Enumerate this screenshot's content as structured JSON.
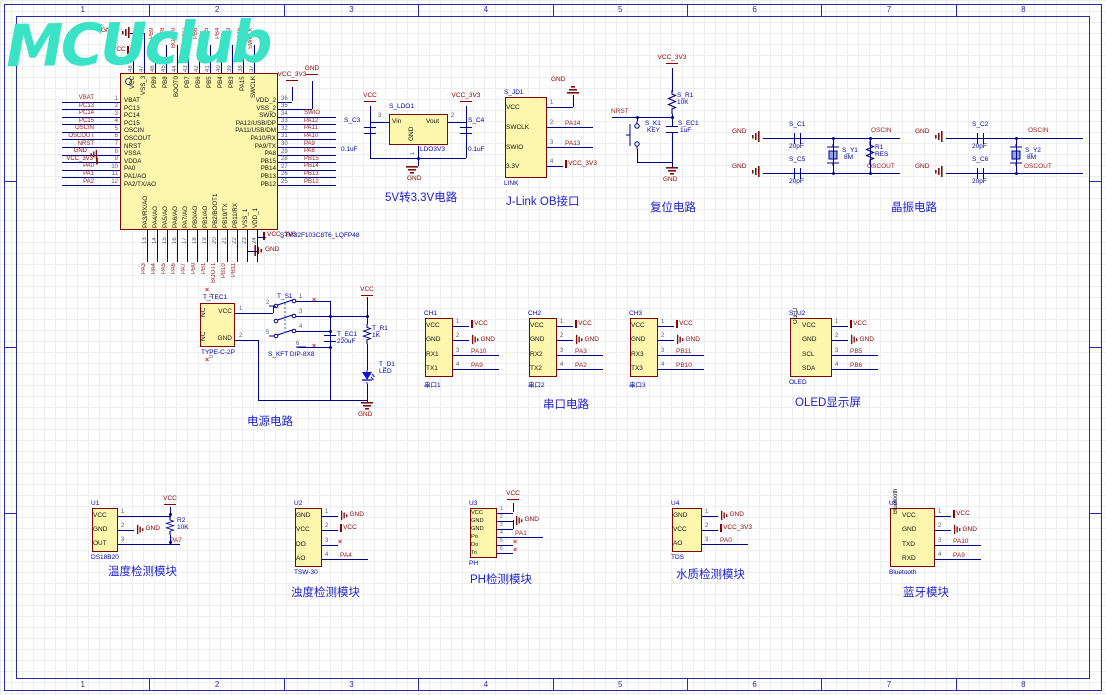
{
  "sheet": {
    "zones": [
      "1",
      "2",
      "3",
      "4",
      "5",
      "6",
      "7",
      "8"
    ]
  },
  "logo": {
    "text": "MCUclub"
  },
  "colors": {
    "wire": "#00008B",
    "net_label": "#9B1C1C",
    "power": "#8B0000",
    "component_fill": "#FCF7AD",
    "component_border": "#7C0606",
    "annotation": "#0202A8",
    "title": "#2121C8",
    "pin_number": "#5C5C74",
    "border": "#2A2AA8",
    "logo": "#3BE3C6"
  },
  "mcu": {
    "part": "STM32F103C8T6_LQFP48",
    "left_pins": [
      {
        "num": "1",
        "name": "VBAT",
        "net": "VBAT",
        "k": "net"
      },
      {
        "num": "2",
        "name": "PC13",
        "net": "PC13",
        "k": "net"
      },
      {
        "num": "3",
        "name": "PC14",
        "net": "PC14",
        "k": "net"
      },
      {
        "num": "4",
        "name": "PC15",
        "net": "PC15",
        "k": "net"
      },
      {
        "num": "5",
        "name": "OSCIN",
        "net": "OSCIN",
        "k": "net"
      },
      {
        "num": "6",
        "name": "OSCOUT",
        "net": "OSCOUT",
        "k": "net"
      },
      {
        "num": "7",
        "name": "NRST",
        "net": "NRST",
        "k": "net"
      },
      {
        "num": "8",
        "name": "VSSA",
        "net": "GND",
        "k": "gnd"
      },
      {
        "num": "9",
        "name": "VDDA",
        "net": "VCC_3V3",
        "k": "vcc"
      },
      {
        "num": "10",
        "name": "PA0",
        "net": "PA0",
        "k": "net"
      },
      {
        "num": "11",
        "name": "PA1/AO",
        "net": "PA1",
        "k": "net"
      },
      {
        "num": "12",
        "name": "PA2/TX/AO",
        "net": "PA2",
        "k": "net"
      }
    ],
    "right_pins": [
      {
        "num": "36",
        "name": "VDD_2",
        "net": "VCC_3V3",
        "k": "up1"
      },
      {
        "num": "35",
        "name": "VSS_2",
        "net": "GND",
        "k": "up2"
      },
      {
        "num": "34",
        "name": "SWIO",
        "net": "SWIO",
        "k": "net"
      },
      {
        "num": "33",
        "name": "PA12/USB/DP",
        "net": "PA12",
        "k": "net"
      },
      {
        "num": "32",
        "name": "PA11/USB/DM",
        "net": "PA11",
        "k": "net"
      },
      {
        "num": "31",
        "name": "PA10/RX",
        "net": "PA10",
        "k": "net"
      },
      {
        "num": "30",
        "name": "PA9/TX",
        "net": "PA9",
        "k": "net"
      },
      {
        "num": "29",
        "name": "PA8",
        "net": "PA8",
        "k": "net"
      },
      {
        "num": "28",
        "name": "PB15",
        "net": "PB15",
        "k": "net"
      },
      {
        "num": "27",
        "name": "PB14",
        "net": "PB14",
        "k": "net"
      },
      {
        "num": "26",
        "name": "PB13",
        "net": "PB13",
        "k": "net"
      },
      {
        "num": "25",
        "name": "PB12",
        "net": "PB12",
        "k": "net"
      }
    ],
    "top_pins": [
      {
        "num": "48",
        "name": "VCC",
        "label": "",
        "k": "none"
      },
      {
        "num": "47",
        "name": "VSS_3",
        "label": "",
        "k": "none"
      },
      {
        "num": "46",
        "name": "PB9",
        "label": "PB9",
        "k": "net"
      },
      {
        "num": "45",
        "name": "PB8",
        "label": "PB8",
        "k": "net"
      },
      {
        "num": "44",
        "name": "BOOT0",
        "label": "BOOT0",
        "k": "net"
      },
      {
        "num": "43",
        "name": "PB7",
        "label": "PB7",
        "k": "net"
      },
      {
        "num": "42",
        "name": "PB6",
        "label": "PB6",
        "k": "net"
      },
      {
        "num": "41",
        "name": "PB5",
        "label": "PB5",
        "k": "net"
      },
      {
        "num": "40",
        "name": "PB4",
        "label": "PB4",
        "k": "net"
      },
      {
        "num": "39",
        "name": "PB3",
        "label": "PB3",
        "k": "net"
      },
      {
        "num": "38",
        "name": "PA15",
        "label": "PA15",
        "k": "net"
      },
      {
        "num": "37",
        "name": "SWCLK",
        "label": "SWCLK",
        "k": "net"
      }
    ],
    "bottom_pins": [
      {
        "num": "13",
        "name": "PA3/RX/AO",
        "label": "PA3",
        "k": "net"
      },
      {
        "num": "14",
        "name": "PA4/AO",
        "label": "PA4",
        "k": "net"
      },
      {
        "num": "15",
        "name": "PA5/AO",
        "label": "PA5",
        "k": "net"
      },
      {
        "num": "16",
        "name": "PA6/AO",
        "label": "PA6",
        "k": "net"
      },
      {
        "num": "17",
        "name": "PA7/AO",
        "label": "PA7",
        "k": "net"
      },
      {
        "num": "18",
        "name": "PB0/AO",
        "label": "PB0",
        "k": "net"
      },
      {
        "num": "19",
        "name": "PB1/AO",
        "label": "PB1",
        "k": "net"
      },
      {
        "num": "20",
        "name": "PB2/BOOT1",
        "label": "BOOT1",
        "k": "net"
      },
      {
        "num": "21",
        "name": "PB10/TX",
        "label": "PB10",
        "k": "net"
      },
      {
        "num": "22",
        "name": "PB11/RX",
        "label": "PB11",
        "k": "net"
      },
      {
        "num": "23",
        "name": "VSS_1",
        "label": "",
        "k": "none"
      },
      {
        "num": "24",
        "name": "VDD_1",
        "label": "",
        "k": "none"
      }
    ],
    "top_nets": {
      "gnd": "GND",
      "vcc": "VCC"
    },
    "right_top_nets": {
      "vcc": "VCC_3V3",
      "gnd": "GND"
    },
    "bottom_nets": {
      "vcc": "VCC_3V3",
      "gnd": "GND"
    }
  },
  "ldo": {
    "title": "5V转3.3V电路",
    "des": "S_LDO1",
    "part": "LDO3V3",
    "vin": "Vin",
    "vout": "Vout",
    "gnd": "GND",
    "n_vin": "3",
    "n_vout": "2",
    "n_gnd": "1",
    "c3": {
      "des": "S_C3",
      "val": "0.1uF"
    },
    "c4": {
      "des": "S_C4",
      "val": "0.1uF"
    },
    "net_in": "VCC",
    "net_out": "VCC_3V3",
    "net_gnd": "GND"
  },
  "jlink": {
    "title": "J-Link OB接口",
    "des": "S_JD1",
    "part": "LINK",
    "gnd_top": "GND",
    "pins": [
      {
        "num": "1",
        "name": "VCC",
        "net": "",
        "k": "up"
      },
      {
        "num": "2",
        "name": "SWCLK",
        "net": "PA14",
        "k": "net"
      },
      {
        "num": "3",
        "name": "SWIO",
        "net": "PA13",
        "k": "net"
      },
      {
        "num": "4",
        "name": "3.3V",
        "net": "VCC_3V3",
        "k": "vcc"
      }
    ]
  },
  "reset": {
    "title": "复位电路",
    "vcc": "VCC_3V3",
    "nrst": "NRST",
    "gnd": "GND",
    "r": {
      "des": "S_R1",
      "val": "10K"
    },
    "key": {
      "des": "S_K1",
      "val": "KEY"
    },
    "cap": {
      "des": "S_EC1",
      "val": "1uF"
    }
  },
  "xtal": {
    "title": "晶振电路",
    "g1": {
      "ctop": {
        "des": "S_C1",
        "val": "20pF"
      },
      "cbot": {
        "des": "S_C5",
        "val": "20pF"
      },
      "y": {
        "des": "S_Y1",
        "val": "8M"
      },
      "r": {
        "des": "R1",
        "val": "RES"
      },
      "top": "OSCIN",
      "bot": "OSCOUT",
      "gnd": "GND"
    },
    "g2": {
      "ctop": {
        "des": "S_C2",
        "val": "20pF"
      },
      "cbot": {
        "des": "S_C6",
        "val": "20pF"
      },
      "y": {
        "des": "S_Y2",
        "val": "8M"
      },
      "top": "OSCIN",
      "bot": "OSCOUT",
      "gnd": "GND"
    }
  },
  "power": {
    "title": "电源电路",
    "vcc": "VCC",
    "gnd": "GND",
    "tec": {
      "des": "T_TEC1",
      "part": "TYPE-C-2P",
      "p_vcc": "VCC",
      "p_gnd": "GND",
      "nc": "NC",
      "n_vcc": "1",
      "n_gnd": "2",
      "n0": "0"
    },
    "sw": {
      "des": "T_S1",
      "part": "S_KFT DIP-8X8",
      "nums": [
        "1",
        "2",
        "3",
        "4",
        "5",
        "6"
      ]
    },
    "cap": {
      "des": "T_EC1",
      "val": "220uF"
    },
    "r": {
      "des": "T_R1",
      "val": "1K"
    },
    "led": {
      "des": "T_D1",
      "val": "LED"
    }
  },
  "serial": {
    "title": "串口电路",
    "connectors": [
      {
        "des": "CH1",
        "part": "串口1",
        "pins": [
          {
            "num": "1",
            "name": "VCC",
            "net": "VCC",
            "k": "vcc"
          },
          {
            "num": "2",
            "name": "GND",
            "net": "GND",
            "k": "gnd"
          },
          {
            "num": "3",
            "name": "RX1",
            "net": "PA10",
            "k": "net"
          },
          {
            "num": "4",
            "name": "TX1",
            "net": "PA9",
            "k": "net"
          }
        ]
      },
      {
        "des": "CH2",
        "part": "串口2",
        "pins": [
          {
            "num": "1",
            "name": "VCC",
            "net": "VCC",
            "k": "vcc"
          },
          {
            "num": "2",
            "name": "GND",
            "net": "GND",
            "k": "gnd"
          },
          {
            "num": "3",
            "name": "RX2",
            "net": "PA3",
            "k": "net"
          },
          {
            "num": "4",
            "name": "TX2",
            "net": "PA2",
            "k": "net"
          }
        ]
      },
      {
        "des": "CH3",
        "part": "串口3",
        "pins": [
          {
            "num": "1",
            "name": "VCC",
            "net": "VCC",
            "k": "vcc"
          },
          {
            "num": "2",
            "name": "GND",
            "net": "GND",
            "k": "gnd"
          },
          {
            "num": "3",
            "name": "RX3",
            "net": "PB11",
            "k": "net"
          },
          {
            "num": "4",
            "name": "TX3",
            "net": "PB10",
            "k": "net"
          }
        ]
      }
    ]
  },
  "oled": {
    "title": "OLED显示屏",
    "des": "S_U2",
    "part": "OLED",
    "side": "OLED",
    "pins": [
      {
        "num": "1",
        "name": "VCC",
        "net": "VCC",
        "k": "vcc"
      },
      {
        "num": "2",
        "name": "GND",
        "net": "GND",
        "k": "gnd"
      },
      {
        "num": "3",
        "name": "SCL",
        "net": "PB5",
        "k": "net"
      },
      {
        "num": "4",
        "name": "SDA",
        "net": "PB6",
        "k": "net"
      }
    ]
  },
  "modules": {
    "u1": {
      "des": "U1",
      "part": "DS18B20",
      "title": "温度检测模块",
      "vcc": "VCC",
      "r2": {
        "des": "R2",
        "val": "10K"
      },
      "pins": [
        {
          "num": "1",
          "name": "VCC",
          "net": "",
          "k": "up52"
        },
        {
          "num": "2",
          "name": "GND",
          "net": "GND",
          "k": "gnd"
        },
        {
          "num": "3",
          "name": "OUT",
          "net": "PA7",
          "k": "netfar"
        }
      ]
    },
    "u2": {
      "des": "U2",
      "part": "TSW-30",
      "title": "浊度检测模块",
      "pins": [
        {
          "num": "1",
          "name": "GND",
          "net": "GND",
          "k": "gnd"
        },
        {
          "num": "2",
          "name": "VCC",
          "net": "VCC",
          "k": "vcc"
        },
        {
          "num": "3",
          "name": "DO",
          "net": "",
          "k": "nc"
        },
        {
          "num": "4",
          "name": "AO",
          "net": "PA4",
          "k": "net"
        }
      ]
    },
    "u3": {
      "des": "U3",
      "part": "PH",
      "title": "PH检测模块",
      "vcc": "VCC",
      "pins": [
        {
          "num": "1",
          "name": "VCC",
          "net": "",
          "k": "up"
        },
        {
          "num": "2",
          "name": "GND",
          "net": "GND",
          "k": "gnd"
        },
        {
          "num": "3",
          "name": "GND",
          "net": "",
          "k": "join"
        },
        {
          "num": "4",
          "name": "Po",
          "net": "PA1",
          "k": "net"
        },
        {
          "num": "5",
          "name": "Do",
          "net": "",
          "k": "nc"
        },
        {
          "num": "6",
          "name": "To",
          "net": "",
          "k": "nc"
        }
      ]
    },
    "u4": {
      "des": "U4",
      "part": "TDS",
      "title": "水质检测模块",
      "pins": [
        {
          "num": "1",
          "name": "GND",
          "net": "GND",
          "k": "gnd"
        },
        {
          "num": "2",
          "name": "VCC",
          "net": "VCC_3V3",
          "k": "vcc"
        },
        {
          "num": "3",
          "name": "AO",
          "net": "PA0",
          "k": "net"
        }
      ]
    },
    "u5": {
      "des": "U5",
      "part": "Bluetooth",
      "title": "蓝牙模块",
      "side": "Bluetooth",
      "pins": [
        {
          "num": "1",
          "name": "VCC",
          "net": "VCC",
          "k": "vcc"
        },
        {
          "num": "2",
          "name": "GND",
          "net": "GND",
          "k": "gnd"
        },
        {
          "num": "3",
          "name": "TXD",
          "net": "PA10",
          "k": "net"
        },
        {
          "num": "4",
          "name": "RXD",
          "net": "PA9",
          "k": "net"
        }
      ]
    }
  }
}
